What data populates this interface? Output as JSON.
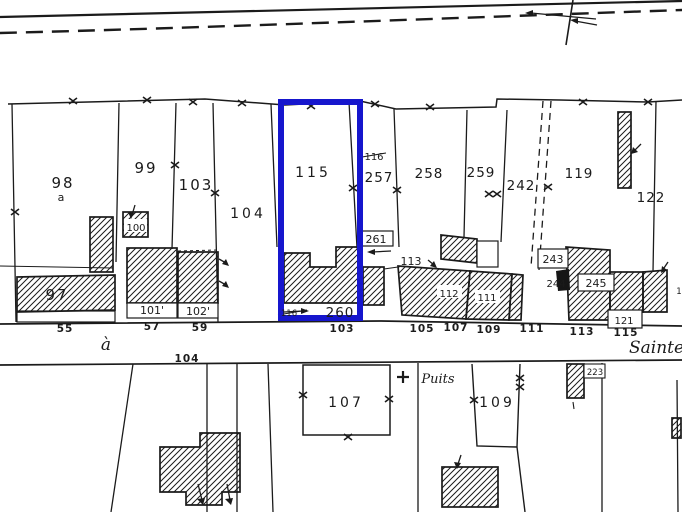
{
  "map": {
    "type": "cadastral-plan",
    "selected_parcel": "115",
    "colors": {
      "highlight": "#1616cd",
      "ink": "#1b1b1b",
      "paper": "#ffffff"
    },
    "icons": {
      "boundary_mark": "✕",
      "well_cross": "✚",
      "hatch": "diagonal-lines"
    },
    "labels": {
      "p98": "98",
      "p98a": "a",
      "p99": "99",
      "p103": "103",
      "p104": "104",
      "p115": "115",
      "p116_old": "116",
      "p257": "257",
      "p258": "258",
      "p259": "259",
      "p242": "242",
      "p119": "119",
      "p122": "122",
      "b97": "97",
      "b100": "100",
      "b101": "101'",
      "b102": "102'",
      "b260": "260",
      "b116_old": "116",
      "b261": "261",
      "b113": "113",
      "b112": "112",
      "b111": "111",
      "b243": "243",
      "b244": "244",
      "b245": "245",
      "b121": "121",
      "b223": "223",
      "s55": "55",
      "s57": "57",
      "s59": "59",
      "s103": "103",
      "s105": "105",
      "s107": "107",
      "s109": "109",
      "s111": "111",
      "s113": "113",
      "s115": "115",
      "street_a": "à",
      "street_104": "104",
      "street_name": "Sainte",
      "low107": "107",
      "low109": "109",
      "puits": "Puits",
      "edge_fragment": "1"
    }
  }
}
